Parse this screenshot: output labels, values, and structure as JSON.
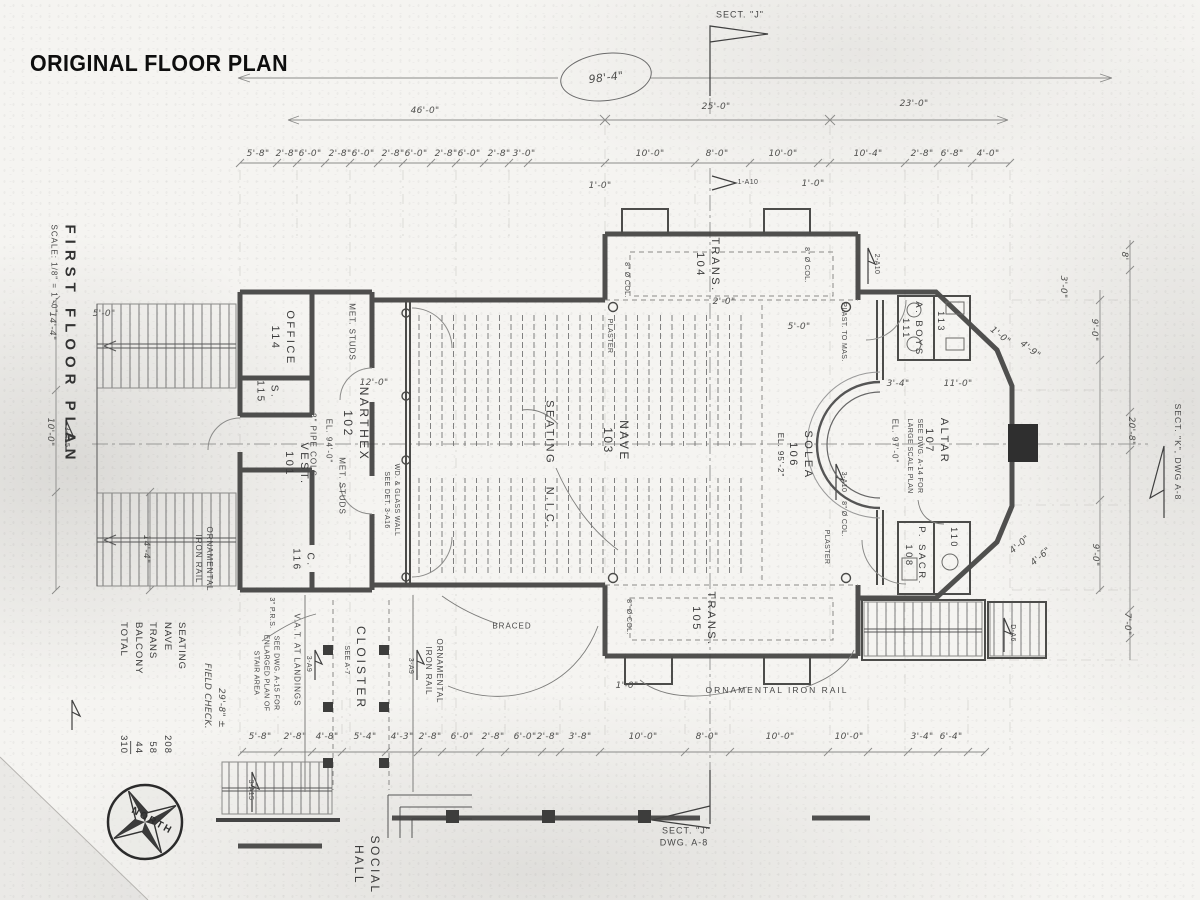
{
  "title": "ORIGINAL FLOOR PLAN",
  "titleblock": {
    "plan": "FIRST FLOOR PLAN",
    "scale": "SCALE: 1/8\" = 1'-0\""
  },
  "overall": "98'-4\"",
  "top_major": [
    "46'-0\"",
    "25'-0\"",
    "23'-0\""
  ],
  "top_minor": [
    "5'-8\"",
    "2'-8\"",
    "6'-0\"",
    "2'-8\"",
    "6'-0\"",
    "2'-8\"",
    "6'-0\"",
    "2'-8\"",
    "6'-0\"",
    "2'-8\"",
    "3'-0\"",
    "10'-0\"",
    "8'-0\"",
    "10'-0\"",
    "10'-4\"",
    "2'-8\"",
    "6'-8\"",
    "4'-0\""
  ],
  "bottom_dims": [
    "5'-8\"",
    "2'-8\"",
    "4'-8\"",
    "5'-4\"",
    "4'-3\"",
    "2'-8\"",
    "6'-0\"",
    "2'-8\"",
    "6'-0\"",
    "2'-8\"",
    "3'-8\"",
    "10'-0\"",
    "8'-0\"",
    "10'-0\"",
    "10'-0\"",
    "3'-4\"",
    "6'-4\""
  ],
  "right_dims": [
    "8'",
    "9'-0\"",
    "20'-8\"",
    "9'-0\"",
    "7'-0\""
  ],
  "left_dims": [
    "14'-4\"",
    "10'-0\"",
    "14'-4\""
  ],
  "inner_dims": {
    "d12_0": "12'-0\"",
    "d5_0a": "5'-0\"",
    "d5_0b": "5'-0\"",
    "d2_0": "2'-0\"",
    "d1_0a": "1'-0\"",
    "d1_0b": "1'-0\"",
    "d1_0c": "1'-0\"",
    "d11_0": "11'-0\"",
    "d3_4": "3'-4\"",
    "d3_0": "3'-0\"",
    "d4_9": "4'-9\"",
    "d1_0d": "1'-0\"",
    "d4_0": "4'-0\"",
    "d4_6": "4'-6\"",
    "field": "29'-8\" ±"
  },
  "rooms": {
    "office": {
      "name": "OFFICE",
      "num": "114"
    },
    "r115": {
      "name": "S.",
      "num": "115"
    },
    "narthex": {
      "name": "NARTHEX",
      "num": "102"
    },
    "vest": {
      "name": "VEST.",
      "num": "101"
    },
    "c116": {
      "name": "C.",
      "num": "116"
    },
    "nave": {
      "name": "NAVE",
      "num": "103"
    },
    "seating_nic": "SEATING N.I.C.",
    "trans_n": {
      "name": "TRANS.",
      "num": "104"
    },
    "trans_s": {
      "name": "TRANS.",
      "num": "105"
    },
    "solea": {
      "name": "SOLEA",
      "num": "106",
      "el": "EL. 95'-2\""
    },
    "altar": {
      "name": "ALTAR",
      "num": "107",
      "el": "EL. 97'-0\"",
      "note1": "SEE DWG. A-14 FOR",
      "note2": "LARGE SCALE PLAN"
    },
    "aboys": {
      "name": "A. BOYS",
      "num": "111"
    },
    "t113": "113",
    "sacr": {
      "name": "P. SACR.",
      "num": "108"
    },
    "r110": "110",
    "cloister": {
      "name": "CLOISTER",
      "ref": "SEE A-7"
    },
    "social": {
      "l1": "SOCIAL",
      "l2": "HALL"
    }
  },
  "notes": {
    "met": "MET. STUDS",
    "el94": "EL. 94'-0\"",
    "pcols": "3\" PIPE COLS",
    "vat": "V.A.T. AT LANDINGS",
    "sn1": "SEE DWG. A-15 FOR",
    "sn2": "ENLARGED PLAN OF",
    "sn3": "STAIR AREA",
    "prs": "3\" P.R.S.",
    "orn1": "ORNAMENTAL",
    "orn2": "IRON RAIL",
    "ornh": "ORNAMENTAL IRON RAIL",
    "fieldchk": "FIELD CHECK.",
    "col8": "8\" Ø COL.",
    "plaster": "PLASTER",
    "pmas": "PLAST. TO MAS.",
    "g1": "WD. & GLASS WALL",
    "g2": "SEE DET. 3-A16",
    "braced": "BRACED"
  },
  "flags": {
    "f1": "3-A15",
    "f2": "3-A15",
    "f3": "1-A10",
    "f4": "2-A10",
    "f5": "3-A10",
    "f6": "3-A9",
    "f7": "3-A9",
    "f8": "D-A6"
  },
  "sections": {
    "top": "SECT. \"J\"",
    "bot1": "SECT. \"J\"",
    "bot2": "DWG. A-8",
    "right": "SECT. \"K\", DWG A-8"
  },
  "north": "NORTH",
  "seating": {
    "title": "SEATING",
    "rows": [
      [
        "NAVE",
        "208"
      ],
      [
        "TRANS",
        "58"
      ],
      [
        "BALCONY",
        "44"
      ],
      [
        "TOTAL",
        "310"
      ]
    ]
  }
}
